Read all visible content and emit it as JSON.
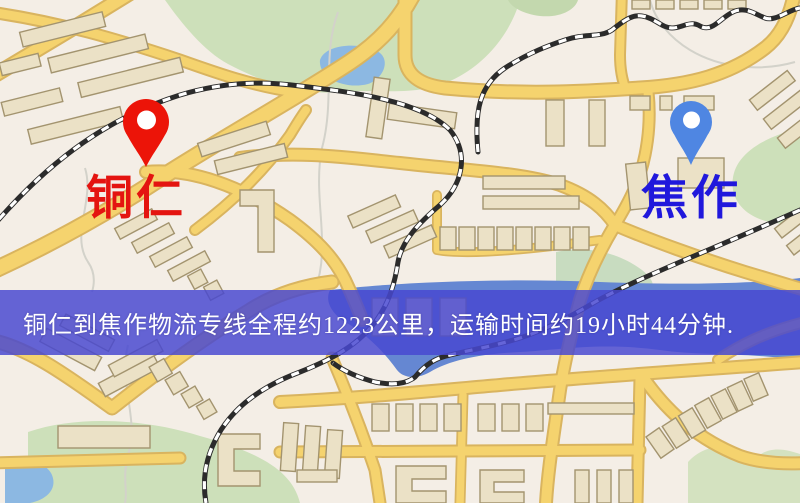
{
  "banner": {
    "text": "铜仁到焦作物流专线全程约1223公里，运输时间约19小时44分钟.",
    "background_color": "rgba(72,72,208,0.84)",
    "text_color": "#ffffff"
  },
  "markers": {
    "origin": {
      "label": "铜仁",
      "pin_color": "#ec1408",
      "label_color": "#e41410"
    },
    "destination": {
      "label": "焦作",
      "pin_color": "#4f86e2",
      "label_color": "#2018dc"
    }
  },
  "map": {
    "palette": {
      "background": "#f4eee6",
      "road_fill": "#f5d36e",
      "road_casing": "#d9b45f",
      "building_fill": "#ebe1c6",
      "building_stroke": "#a3946f",
      "park_green": "#cde0ba",
      "water_blue": "#8cb8e2",
      "river_blue": "#6587d2",
      "railway": "#2b2b2b"
    }
  }
}
